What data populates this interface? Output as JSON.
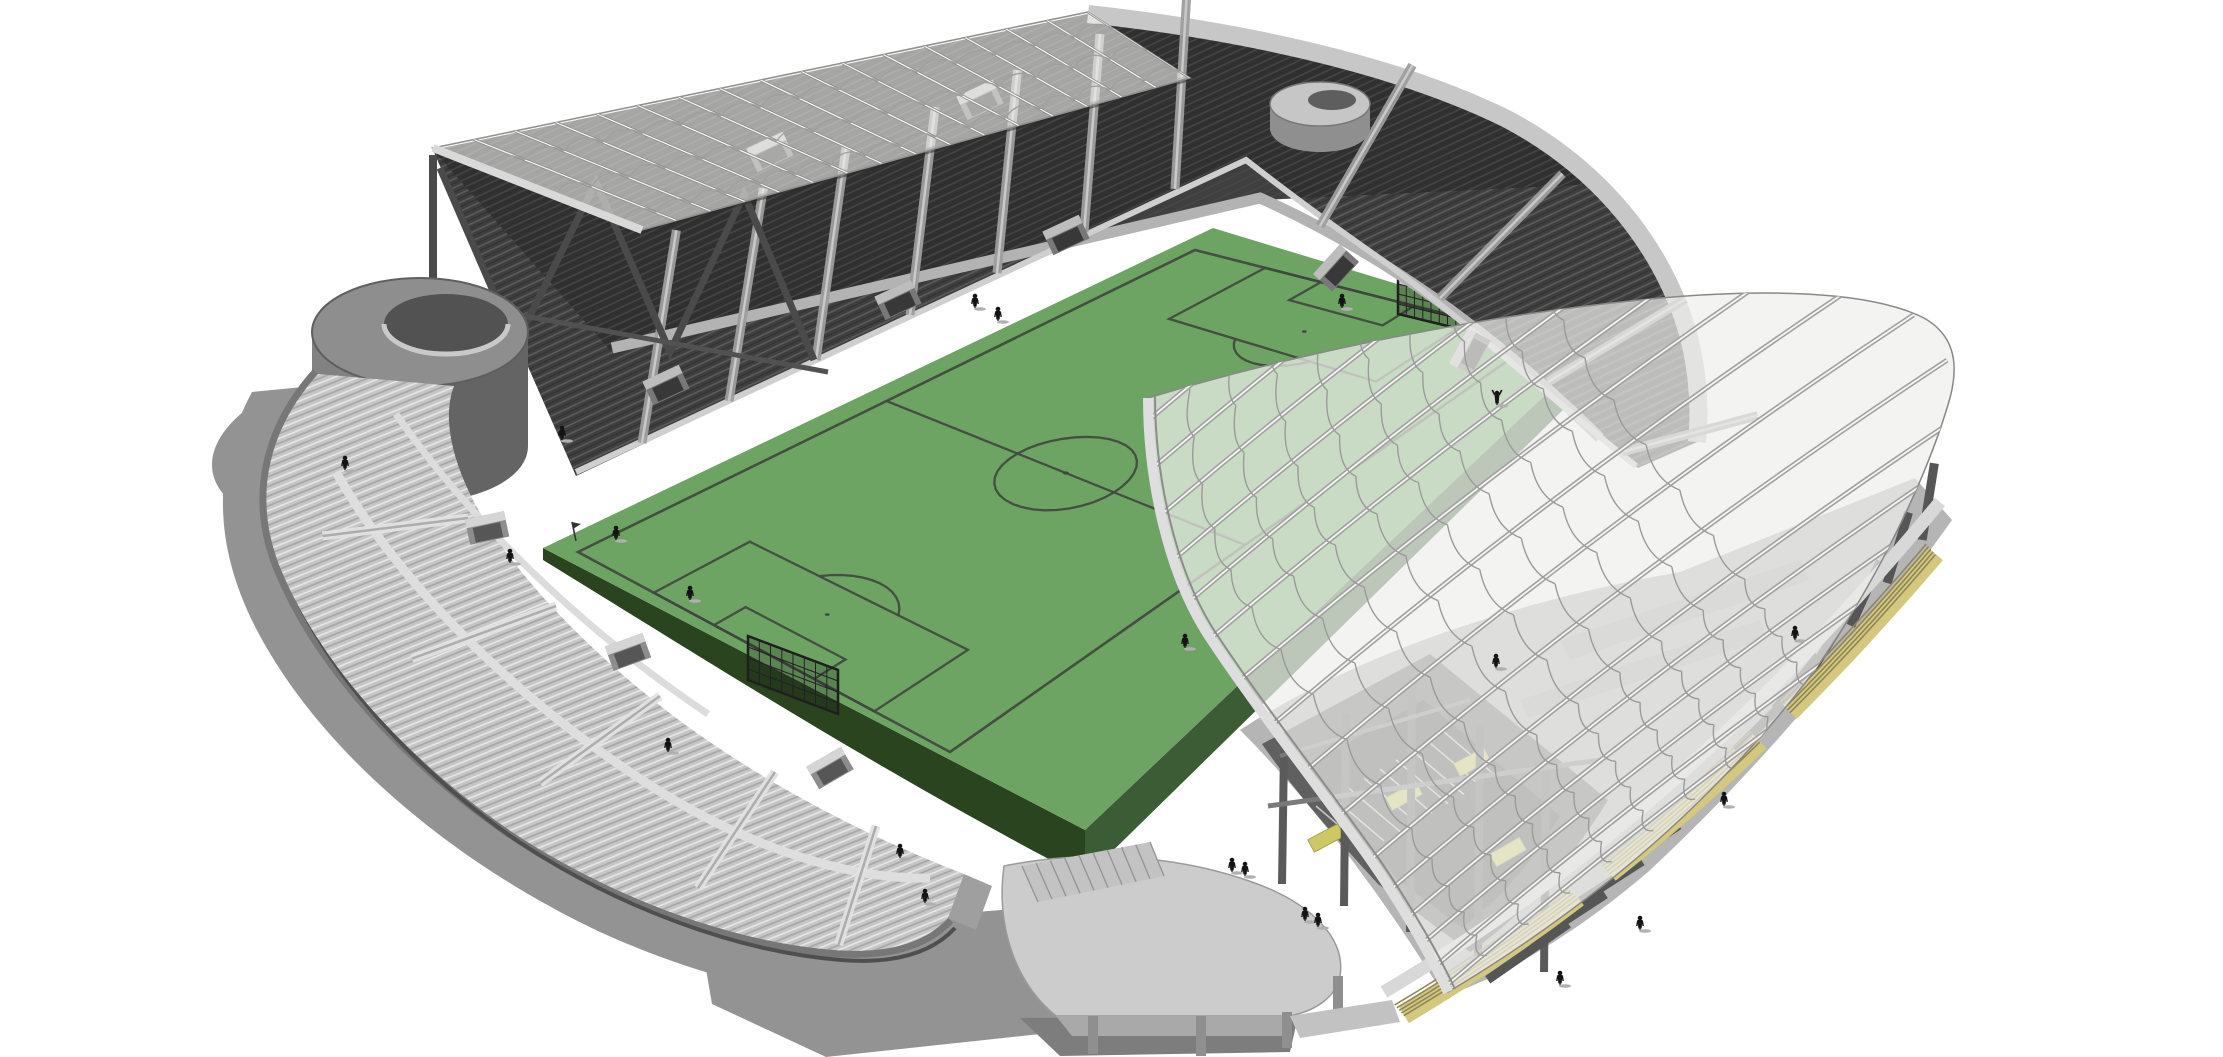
{
  "scene": {
    "type": "architectural-3d-render",
    "subject": "football-stadium-massing-model",
    "background": "#ffffff"
  },
  "palette": {
    "bg": "#ffffff",
    "shadow": "#939393",
    "shadow_dark": "#7d7d7d",
    "pitch_green": "#6da463",
    "pitch_side": "#3c5c36",
    "pitch_side_dark": "#2a441f",
    "pitch_line": "#3f463e",
    "stand_dark": "#3e3e3e",
    "stand_darker": "#2f2f2f",
    "stand_row_hi": "#5c5c5c",
    "stand_light": "#c6c6c6",
    "stand_light_row": "#a4a4a4",
    "stand_light_hi": "#ebebeb",
    "rim_light": "#c7c7c7",
    "walkway": "#b3b3b3",
    "concrete": "#8f8f8f",
    "wall_gray": "#777777",
    "canopy_east_fill": "#eef0ec",
    "canopy_nw_fill": "#f4f4f2",
    "canopy_rib": "#8f8f8f",
    "gutter": "#dedede",
    "fin_gray": "#565656",
    "plinth_yellow": "#d4c87e",
    "plinth_line": "#8f8657",
    "stair_yellow": "#cdc863",
    "person": "#141414"
  },
  "pitch": {
    "platform_corners": [
      [
        1213,
        228
      ],
      [
        1598,
        345
      ],
      [
        1085,
        830
      ],
      [
        543,
        548
      ]
    ],
    "marked_corners": [
      [
        1195,
        250
      ],
      [
        1540,
        338
      ],
      [
        950,
        752
      ],
      [
        578,
        552
      ]
    ],
    "length_m": 105,
    "width_m": 68,
    "center_circle_radius_m": 9.15,
    "penalty_area": {
      "depth_m": 16.5,
      "width_m": 40.32
    },
    "goal_area": {
      "depth_m": 5.5,
      "width_m": 18.32
    },
    "penalty_spot_m": 11,
    "line_width_px": 2.3
  },
  "goals": {
    "far": [
      [
        1398,
        274
      ],
      [
        1464,
        290
      ],
      [
        1464,
        330
      ],
      [
        1398,
        314
      ]
    ],
    "near": [
      [
        748,
        636
      ],
      [
        838,
        670
      ],
      [
        838,
        714
      ],
      [
        748,
        680
      ]
    ]
  },
  "corner_flag": [
    576,
    541
  ],
  "people": [
    [
      975,
      308
    ],
    [
      998,
      321
    ],
    [
      1342,
      308
    ],
    [
      1497,
      405,
      "up"
    ],
    [
      616,
      540
    ],
    [
      1185,
      648
    ],
    [
      562,
      440
    ],
    [
      345,
      470
    ],
    [
      510,
      563
    ],
    [
      690,
      600
    ],
    [
      668,
      752
    ],
    [
      900,
      858
    ],
    [
      925,
      903
    ],
    [
      1232,
      872
    ],
    [
      1245,
      876
    ],
    [
      1496,
      668
    ],
    [
      1724,
      806
    ],
    [
      1640,
      930
    ],
    [
      1305,
      921
    ],
    [
      1318,
      927
    ],
    [
      1795,
      640
    ],
    [
      1560,
      985
    ]
  ],
  "aisles": {
    "main_stand": [
      [
        642,
        443,
        0.16,
        -0.99,
        215
      ],
      [
        729,
        401,
        0.16,
        -0.99,
        215
      ],
      [
        816,
        360,
        0.14,
        -0.99,
        215
      ],
      [
        910,
        315,
        0.12,
        -0.99,
        210
      ],
      [
        997,
        273,
        0.1,
        -0.99,
        205
      ],
      [
        1084,
        232,
        0.08,
        -0.99,
        200
      ],
      [
        1175,
        189,
        0.06,
        -0.99,
        195
      ],
      [
        1320,
        226,
        0.5,
        -0.87,
        185
      ],
      [
        1440,
        298,
        0.7,
        -0.71,
        175
      ],
      [
        1548,
        382,
        0.86,
        -0.52,
        160
      ],
      [
        1622,
        452,
        0.97,
        -0.26,
        140
      ]
    ],
    "curve_stand": [
      [
        468,
        518,
        -0.97,
        0.12,
        150
      ],
      [
        556,
        606,
        -0.93,
        0.34,
        155
      ],
      [
        660,
        696,
        -0.8,
        0.58,
        150
      ],
      [
        775,
        772,
        -0.55,
        0.83,
        140
      ],
      [
        876,
        826,
        -0.3,
        0.95,
        125
      ]
    ]
  },
  "vomitories": {
    "main_stand": [
      [
        666,
        385,
        -25
      ],
      [
        898,
        300,
        -25
      ],
      [
        1066,
        235,
        -25
      ],
      [
        770,
        152,
        -25
      ],
      [
        980,
        100,
        -25
      ],
      [
        1336,
        268,
        -48
      ],
      [
        1470,
        352,
        -62
      ]
    ],
    "curve_stand": [
      [
        487,
        528,
        -12
      ],
      [
        628,
        652,
        -20
      ],
      [
        830,
        768,
        -30
      ]
    ]
  },
  "truss": {
    "points": [
      [
        440,
        168
      ],
      [
        516,
        344
      ],
      [
        596,
        182
      ],
      [
        670,
        352
      ],
      [
        744,
        194
      ],
      [
        814,
        360
      ]
    ]
  },
  "canopy_main": {
    "rib_count": 17,
    "scallop_rows": [
      0.25,
      0.58,
      0.9
    ],
    "top_edge": [
      [
        433,
        148
      ],
      [
        1088,
        12
      ]
    ],
    "bottom_edge": [
      [
        642,
        230
      ],
      [
        1190,
        78
      ]
    ]
  },
  "canopy_east": {
    "rafter_count": 16,
    "rafter_dir": [
      0.8,
      -0.6
    ],
    "scallop_rows": 9,
    "scallop_spacing_px": 52,
    "leading_edge": [
      [
        1148,
        398
      ],
      [
        1148,
        480
      ],
      [
        1168,
        570
      ],
      [
        1205,
        630
      ],
      [
        1250,
        700
      ],
      [
        1320,
        788
      ],
      [
        1372,
        862
      ],
      [
        1408,
        914
      ],
      [
        1434,
        962
      ],
      [
        1448,
        992
      ]
    ]
  },
  "east_facade": {
    "fin_count": 12,
    "fin_top": [
      [
        1560,
        930
      ],
      [
        1700,
        828
      ],
      [
        1848,
        640
      ],
      [
        1940,
        452
      ]
    ],
    "fin_base": [
      [
        1478,
        988
      ],
      [
        1640,
        852
      ],
      [
        1800,
        696
      ],
      [
        1930,
        530
      ]
    ],
    "plinth": [
      [
        1392,
        1002
      ],
      [
        1560,
        902
      ],
      [
        1742,
        760
      ],
      [
        1948,
        512
      ]
    ],
    "plinth_stripes": 5,
    "columns": [
      [
        1284,
        750,
        1282,
        884
      ],
      [
        1346,
        714,
        1344,
        906
      ],
      [
        1412,
        678,
        1410,
        932
      ],
      [
        1480,
        726,
        1478,
        956
      ],
      [
        1546,
        772,
        1544,
        972
      ]
    ],
    "stair_patches": [
      [
        1326,
        838,
        -28
      ],
      [
        1404,
        796,
        -28
      ],
      [
        1472,
        762,
        -28
      ],
      [
        1508,
        852,
        -30
      ]
    ],
    "mouth_stair_lines": 9
  },
  "ramp": {
    "stair_steps": 9
  }
}
